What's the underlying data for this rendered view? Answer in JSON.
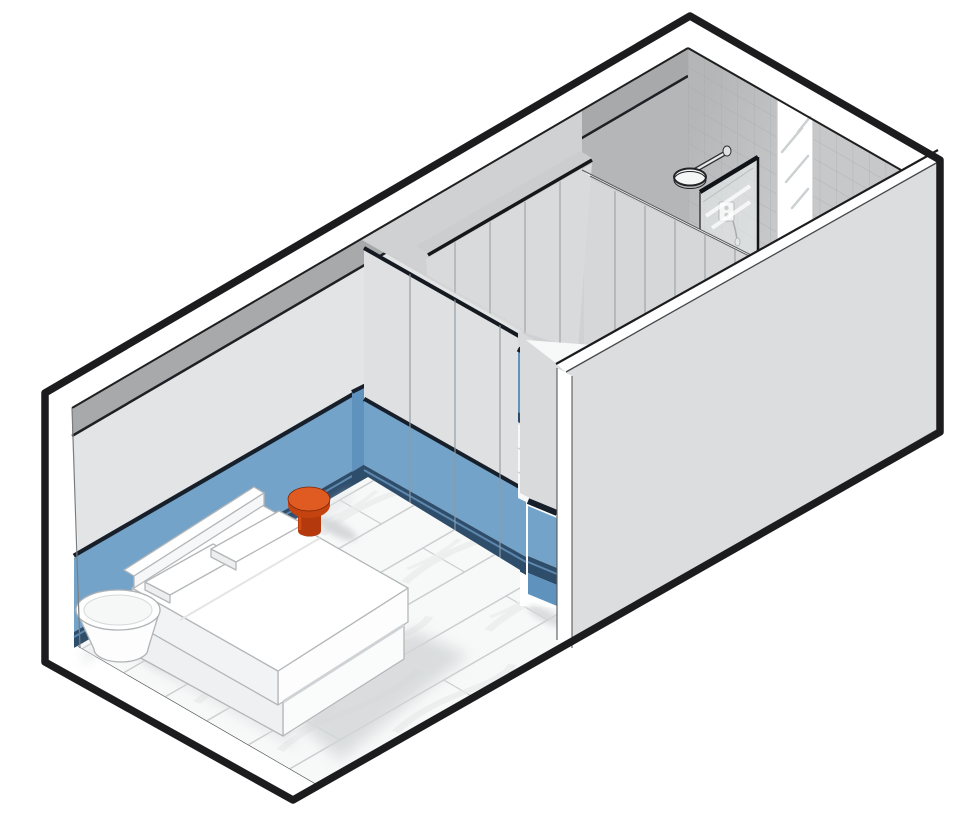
{
  "meta": {
    "type": "axonometric-interior-cutaway",
    "description": "Isometric cutaway architectural drawing of a rectangular hotel-style suite: bedroom with blue wainscot and platform bed, walk-through wardrobe corridor, and shower bathroom with tiled end wall, frosted window strip, glass screen and rain shower.",
    "canvas_width": 973,
    "canvas_height": 832
  },
  "rooms": [
    {
      "name": "bedroom"
    },
    {
      "name": "walk-through-closet"
    },
    {
      "name": "shower-bathroom"
    }
  ],
  "objects": [
    {
      "name": "platform-bed",
      "parts": [
        "mattress",
        "platform",
        "headboard",
        "pillow-left",
        "pillow-right"
      ],
      "color_ref": "bedWhite"
    },
    {
      "name": "side-table-orange",
      "shape": "mushroom stool",
      "color_ref": "accentOrangeTop"
    },
    {
      "name": "stool-white",
      "shape": "tapered cylinder",
      "color_ref": "bedWhite"
    },
    {
      "name": "rain-shower-head",
      "mount": "tiled end wall",
      "color_ref": "white"
    },
    {
      "name": "shower-mixer-panel",
      "color_ref": "white"
    },
    {
      "name": "hand-shower",
      "color_ref": "white"
    },
    {
      "name": "glass-shower-screen",
      "color_ref": "glass"
    },
    {
      "name": "wardrobe-run",
      "location": "closet corridor",
      "color_ref": "doorGray"
    },
    {
      "name": "wainscot-panels",
      "color_ref": "wainscotBlue"
    },
    {
      "name": "wood-plank-floor",
      "color_ref": "floorBase"
    },
    {
      "name": "frosted-window-strip",
      "color_ref": "white"
    }
  ],
  "colors": {
    "outline": "#1c1c1e",
    "white": "#ffffff",
    "wallLight": "#e3e4e5",
    "wallTopBand": "#a8a9ab",
    "wallBathroom": "#b4b6b8",
    "tileBase": "#c6c8c9",
    "tileLine": "#a9adaf",
    "exteriorWall": "#dcddde",
    "cutGray": "#cbcdce",
    "corridorGray": "#cfd1d3",
    "panelGray": "#d6d7d9",
    "doorGray": "#d9dadb",
    "partitionFace": "#dfe0e1",
    "wainscotBlue": "#74a3c9",
    "wainscotBlueDeep": "#5f93bd",
    "trimNavy": "#2e4d6b",
    "trimNavyLight": "#4f7ba6",
    "floorBase": "#f7f8f8",
    "plankLine": "#c5c8ca",
    "grainLine": "#e9ebeb",
    "shadow": "#d3d6d8",
    "bedWhite": "#ffffff",
    "bedShadeLight": "#f2f3f4",
    "furnitureLine": "#b4b7b9",
    "accentOrangeTop": "#e05b22",
    "accentOrangeSide": "#c4430f",
    "accentOrangeDark": "#b43a0e",
    "glass": "#eef2f3",
    "fixtureLine": "#2e3134"
  }
}
